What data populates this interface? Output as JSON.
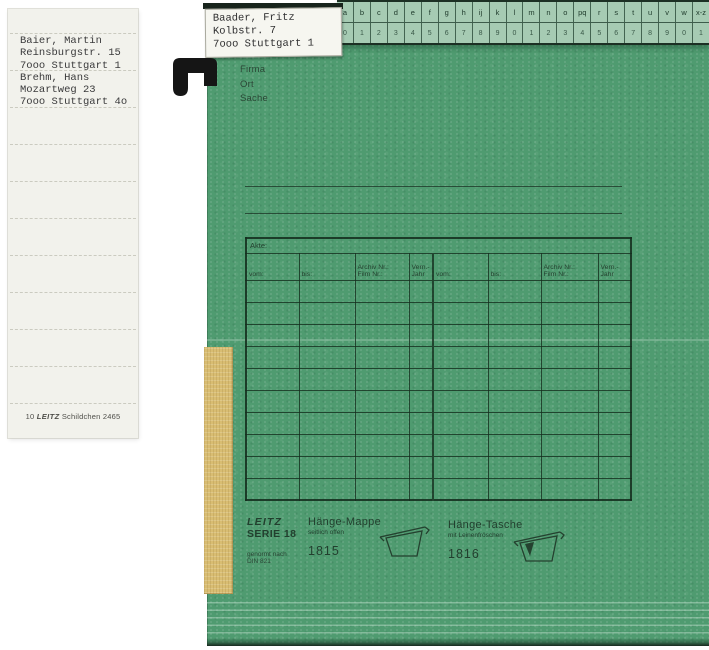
{
  "label_sheet": {
    "lines": [
      "Baier, Martin",
      "Reinsburgstr. 15",
      "7ooo Stuttgart 1",
      "Brehm, Hans",
      "Mozartweg 23",
      "7ooo Stuttgart 4o"
    ],
    "caption_count": "10",
    "caption_brand": "LEITZ",
    "caption_text": "Schildchen 2465"
  },
  "folder": {
    "top_label_lines": [
      "Baader, Fritz",
      "Kolbstr. 7",
      "7ooo Stuttgart 1"
    ],
    "index_strip": {
      "letters": [
        "a",
        "b",
        "c",
        "d",
        "e",
        "f",
        "g",
        "h",
        "ij",
        "k",
        "l",
        "m",
        "n",
        "o",
        "pq",
        "r",
        "s",
        "t",
        "u",
        "v",
        "w",
        "x-z"
      ],
      "numbers": [
        "0",
        "1",
        "2",
        "3",
        "4",
        "5",
        "6",
        "7",
        "8",
        "9",
        "0",
        "1",
        "2",
        "3",
        "4",
        "5",
        "6",
        "7",
        "8",
        "9",
        "0",
        "1"
      ]
    },
    "fields": [
      "Firma",
      "Ort",
      "Sache"
    ],
    "table": {
      "akte_label": "Akte:",
      "columns": [
        {
          "line1": "vom:",
          "line2": ""
        },
        {
          "line1": "bis:",
          "line2": ""
        },
        {
          "line1": "Archiv Nr.:",
          "line2": "Film Nr.:"
        },
        {
          "line1": "Vern.-",
          "line2": "Jahr"
        },
        {
          "line1": "vom:",
          "line2": ""
        },
        {
          "line1": "bis:",
          "line2": ""
        },
        {
          "line1": "Archiv Nr.:",
          "line2": "Film Nr.:"
        },
        {
          "line1": "Vern.-",
          "line2": "Jahr"
        }
      ],
      "body_rows": 10,
      "column_widths_px": [
        53,
        56,
        54,
        24,
        55,
        53,
        57,
        33
      ]
    },
    "footer": {
      "brand": "LEITZ",
      "series": "SERIE 18",
      "din_line1": "genormt nach",
      "din_line2": "DIN 821",
      "products": [
        {
          "name": "Hänge-Mappe",
          "subtitle": "seitlich offen",
          "number": "1815"
        },
        {
          "name": "Hänge-Tasche",
          "subtitle": "mit Leinenfröschen",
          "number": "1816"
        }
      ]
    },
    "colors": {
      "body_green": "#4f9b70",
      "strip_green": "#a6cbb3",
      "line_dark": "#24412f",
      "tape_yellow": "#d9bd72",
      "hook_black": "#151515"
    }
  }
}
